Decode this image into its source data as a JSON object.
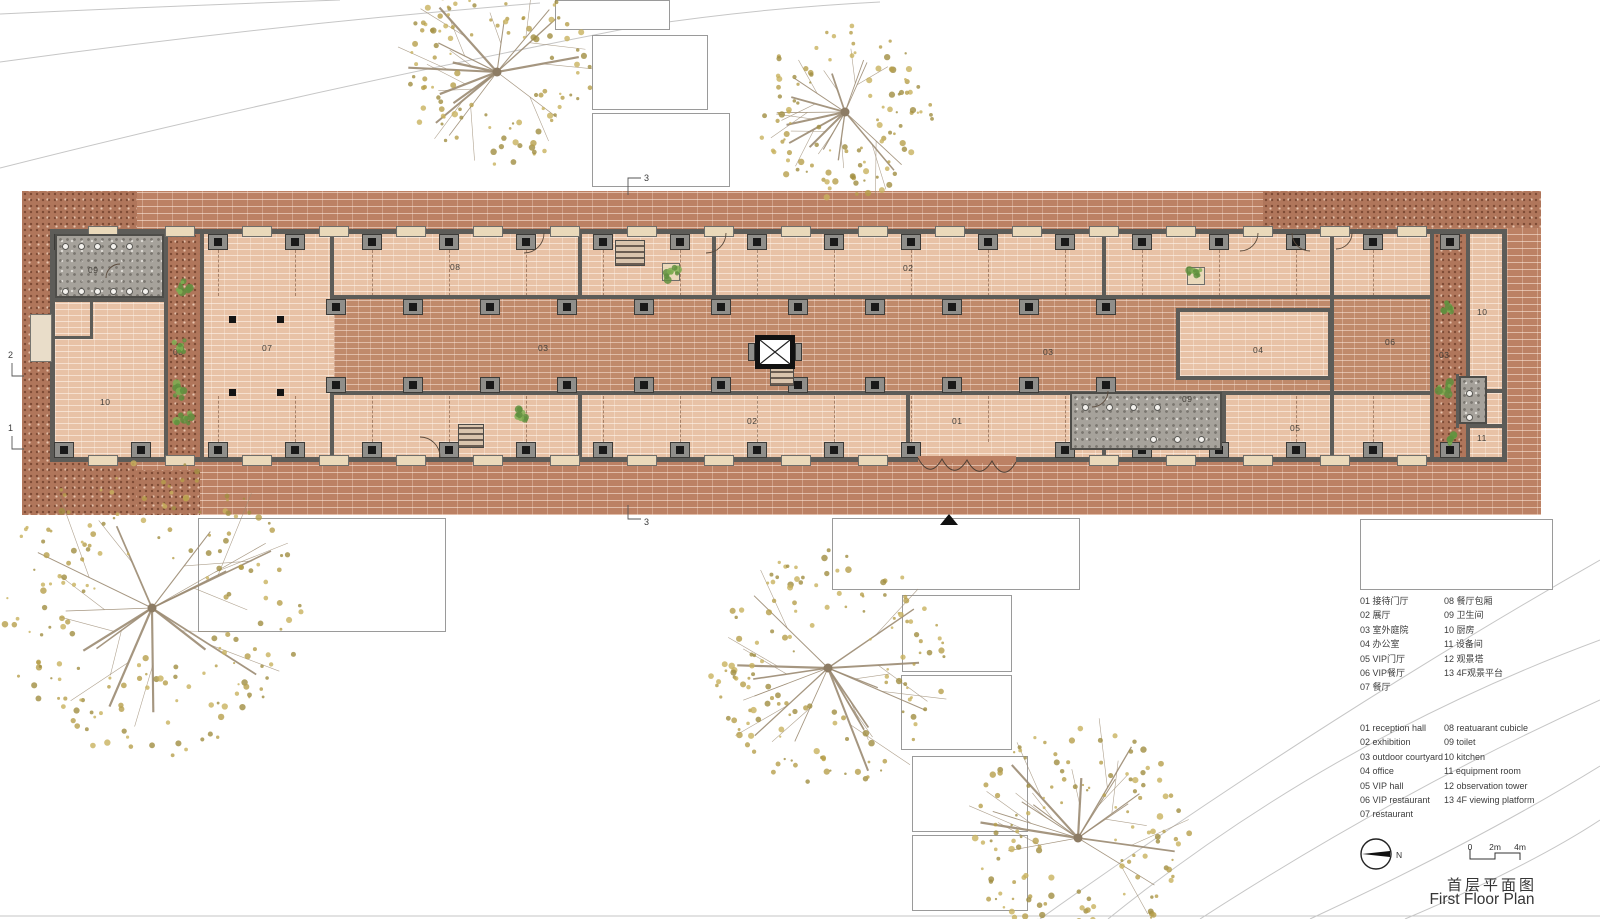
{
  "canvas": {
    "w": 1600,
    "h": 919
  },
  "title_block": {
    "title_cn": "首层平面图",
    "title_en": "First Floor Plan",
    "north_label": "N",
    "scale_ticks": [
      "0",
      "2m",
      "4m"
    ]
  },
  "legend_cn": {
    "col1": [
      "01 接待门厅",
      "02 展厅",
      "03 室外庭院",
      "04 办公室",
      "05 VIP门厅",
      "06 VIP餐厅",
      "07 餐厅"
    ],
    "col2": [
      "08 餐厅包厢",
      "09 卫生间",
      "10 厨房",
      "11 设备间",
      "12 观景塔",
      "13 4F观景平台"
    ]
  },
  "legend_en": {
    "col1": [
      "01 reception hall",
      "02 exhibition",
      "03 outdoor courtyard",
      "04 office",
      "05 VIP hall",
      "06 VIP restaurant",
      "07 restaurant"
    ],
    "col2": [
      "08 reatuarant cubicle",
      "09 toilet",
      "10 kitchen",
      "11 equipment room",
      "12 observation tower",
      "13 4F viewing platform"
    ]
  },
  "section_markers": [
    {
      "label": "3",
      "tx": 644,
      "ty": 181,
      "path": "M628,195 L628,178 L641,178"
    },
    {
      "label": "3",
      "tx": 644,
      "ty": 525,
      "path": "M628,505 L628,519 L641,519"
    },
    {
      "label": "2",
      "tx": 8,
      "ty": 358,
      "path": "M12,363 L12,376 L24,376"
    },
    {
      "label": "1",
      "tx": 8,
      "ty": 431,
      "path": "M12,436 L12,449 L24,449"
    }
  ],
  "colors": {
    "band": "#bc8164",
    "speckle": "#b0765b",
    "floor": "#e8c2a6",
    "corridor": "#c08a6b",
    "wall": "#5d5c58",
    "column": "#191919",
    "pilaster": "#8f8e8a",
    "sill": "#ead9ba",
    "toilet_floor": "#a6a29b",
    "tree_leaf": [
      "#b79f4b",
      "#c8b25e",
      "#a08d41"
    ],
    "branch": "#9c8b73",
    "plant_green": "#5f8f3e",
    "curve": "#c6c6c6",
    "text": "#3c3c3c"
  },
  "plan": {
    "band": [
      22,
      191,
      1519,
      324
    ],
    "speckles": [
      [
        22,
        191,
        115,
        324
      ],
      [
        137,
        470,
        63,
        45
      ],
      [
        1263,
        191,
        278,
        37
      ]
    ],
    "building_floor": [
      55,
      234,
      1450,
      226
    ],
    "corridor": [
      334,
      299,
      1098,
      92
    ],
    "courtyards": [
      [
        168,
        233,
        32,
        226
      ],
      [
        1434,
        233,
        32,
        226
      ]
    ],
    "walls": [
      [
        50,
        229,
        1457,
        5
      ],
      [
        50,
        457,
        1457,
        5
      ],
      [
        50,
        229,
        5,
        233
      ],
      [
        1502,
        229,
        5,
        233
      ],
      [
        330,
        295,
        1104,
        4
      ],
      [
        330,
        391,
        1104,
        4
      ],
      [
        164,
        229,
        4,
        233
      ],
      [
        200,
        229,
        4,
        233
      ],
      [
        1430,
        229,
        4,
        233
      ],
      [
        1466,
        229,
        4,
        233
      ],
      [
        330,
        229,
        4,
        70
      ],
      [
        578,
        229,
        4,
        70
      ],
      [
        712,
        229,
        4,
        70
      ],
      [
        1102,
        229,
        4,
        70
      ],
      [
        1330,
        229,
        4,
        233
      ],
      [
        330,
        391,
        4,
        71
      ],
      [
        578,
        391,
        4,
        71
      ],
      [
        906,
        391,
        4,
        71
      ],
      [
        1102,
        391,
        4,
        71
      ],
      [
        1222,
        391,
        4,
        71
      ],
      [
        50,
        298,
        116,
        4
      ],
      [
        50,
        264,
        116,
        3
      ],
      [
        50,
        336,
        40,
        3
      ],
      [
        90,
        298,
        3,
        41
      ],
      [
        1176,
        308,
        156,
        4
      ],
      [
        1176,
        376,
        156,
        4
      ],
      [
        1176,
        308,
        4,
        72
      ],
      [
        1328,
        308,
        4,
        72
      ],
      [
        1466,
        389,
        40,
        4
      ],
      [
        1466,
        424,
        40,
        4
      ],
      [
        1456,
        374,
        3,
        54
      ]
    ],
    "room04_floor": [
      1180,
      312,
      148,
      64
    ],
    "facades": [
      {
        "y": 234,
        "dir": "down",
        "x0": 64,
        "x1": 1460,
        "step": 77,
        "sill_y": 226,
        "skip": []
      },
      {
        "y": 442,
        "dir": "up",
        "x0": 64,
        "x1": 1460,
        "step": 77,
        "sill_y": 455,
        "skip": [
          915,
          1025
        ]
      },
      {
        "y": 299,
        "dir": "down",
        "x0": 336,
        "x1": 1170,
        "step": 77,
        "sill_y": -1,
        "skip": []
      },
      {
        "y": 377,
        "dir": "up",
        "x0": 336,
        "x1": 1170,
        "step": 77,
        "sill_y": -1,
        "skip": []
      }
    ],
    "dash_rows": [
      [
        250,
        46
      ],
      [
        396,
        46
      ]
    ],
    "entrance": {
      "cover": [
        918,
        456,
        98,
        7
      ],
      "scallops": "M918,458 q12,22 24,1 q12,22 25,1 q12,22 25,1 q12,22 24,1"
    },
    "elevator": {
      "box": [
        755,
        335,
        40,
        34
      ]
    },
    "stairs": [
      [
        615,
        240,
        30,
        26
      ],
      [
        458,
        424,
        26,
        24
      ],
      [
        770,
        366,
        24,
        20
      ]
    ],
    "toilets": [
      {
        "rect": [
          55,
          234,
          109,
          64
        ],
        "fixture_rows": [
          [
            62,
            243,
            5,
            16
          ],
          [
            62,
            288,
            6,
            16
          ]
        ]
      },
      {
        "rect": [
          1070,
          392,
          152,
          58
        ],
        "fixture_rows": [
          [
            1082,
            404,
            4,
            24
          ],
          [
            1150,
            436,
            3,
            24
          ]
        ]
      },
      {
        "rect": [
          1459,
          376,
          28,
          48
        ],
        "fixture_rows": [
          [
            1466,
            390,
            1,
            0
          ],
          [
            1466,
            414,
            1,
            0
          ]
        ]
      }
    ],
    "ramp": [
      30,
      314,
      22,
      48
    ],
    "columns": [
      [
        229,
        316
      ],
      [
        277,
        316
      ],
      [
        229,
        389
      ],
      [
        277,
        389
      ]
    ],
    "room_labels": [
      {
        "t": "09",
        "x": 98,
        "y": 270
      },
      {
        "t": "03",
        "x": 183,
        "y": 352
      },
      {
        "t": "07",
        "x": 272,
        "y": 348
      },
      {
        "t": "10",
        "x": 110,
        "y": 402
      },
      {
        "t": "08",
        "x": 460,
        "y": 267
      },
      {
        "t": "03",
        "x": 548,
        "y": 348
      },
      {
        "t": "02",
        "x": 913,
        "y": 268
      },
      {
        "t": "02",
        "x": 757,
        "y": 421
      },
      {
        "t": "01",
        "x": 962,
        "y": 421
      },
      {
        "t": "03",
        "x": 1053,
        "y": 352
      },
      {
        "t": "09",
        "x": 1192,
        "y": 399
      },
      {
        "t": "04",
        "x": 1263,
        "y": 350
      },
      {
        "t": "05",
        "x": 1300,
        "y": 428
      },
      {
        "t": "06",
        "x": 1395,
        "y": 342
      },
      {
        "t": "03",
        "x": 1449,
        "y": 355
      },
      {
        "t": "10",
        "x": 1487,
        "y": 312
      },
      {
        "t": "11",
        "x": 1487,
        "y": 438
      }
    ],
    "door_arcs": [
      "M544,233 a20,20 0 0 1 -20,20",
      "M726,233 a20,20 0 0 1 -20,20",
      "M1258,233 a18,18 0 0 1 -18,18",
      "M1292,233 a18,18 0 0 0 18,18",
      "M1352,233 a16,16 0 0 1 -16,16",
      "M440,457 a20,20 0 0 0 -20,-20",
      "M120,264 a14,14 0 0 0 -14,14",
      "M1108,391 a16,16 0 0 1 -16,16"
    ],
    "planters": [
      [
        662,
        263,
        18,
        18
      ],
      [
        1187,
        267,
        18,
        18
      ]
    ],
    "plants": [
      [
        671,
        272
      ],
      [
        1196,
        276
      ],
      [
        524,
        416
      ],
      [
        182,
        290
      ],
      [
        180,
        348
      ],
      [
        179,
        390
      ],
      [
        184,
        420
      ],
      [
        1448,
        310
      ],
      [
        1447,
        388
      ],
      [
        1449,
        440
      ]
    ],
    "white_rects": [
      [
        555,
        0,
        115,
        30
      ],
      [
        592,
        35,
        116,
        75
      ],
      [
        592,
        113,
        138,
        74
      ],
      [
        198,
        518,
        248,
        114
      ],
      [
        832,
        518,
        248,
        72
      ],
      [
        902,
        595,
        110,
        77
      ],
      [
        901,
        675,
        111,
        75
      ],
      [
        912,
        756,
        116,
        76
      ],
      [
        912,
        835,
        116,
        76
      ]
    ],
    "legend_box": [
      1360,
      519,
      193,
      71
    ],
    "triangle": [
      940,
      514
    ],
    "trees": [
      {
        "cx": 497,
        "cy": 72,
        "r": 95
      },
      {
        "cx": 845,
        "cy": 112,
        "r": 88
      },
      {
        "cx": 152,
        "cy": 608,
        "r": 150
      },
      {
        "cx": 828,
        "cy": 668,
        "r": 118
      },
      {
        "cx": 1078,
        "cy": 838,
        "r": 112
      }
    ],
    "site_curves": [
      "M0,14 Q170,6 340,0",
      "M0,62 Q260,26 540,3",
      "M0,168 Q300,92 640,26 Q760,8 880,2",
      "M1040,919 Q1320,720 1600,560",
      "M1108,919 Q1330,740 1600,640",
      "M1200,919 Q1400,790 1600,700",
      "M1310,919 Q1480,840 1600,766",
      "M1405,919 Q1530,866 1600,820",
      "M0,916 L1600,916"
    ],
    "north": {
      "cx": 1376,
      "cy": 854,
      "r": 15,
      "label_x": 1396,
      "label_y": 858
    },
    "scalebar": {
      "x0": 1470,
      "x1": 1495,
      "x2": 1520,
      "y_low": 859,
      "y_high": 853,
      "label_y": 842
    },
    "title_pos": {
      "cn": [
        1492,
        874
      ],
      "en": [
        1482,
        891
      ]
    }
  }
}
